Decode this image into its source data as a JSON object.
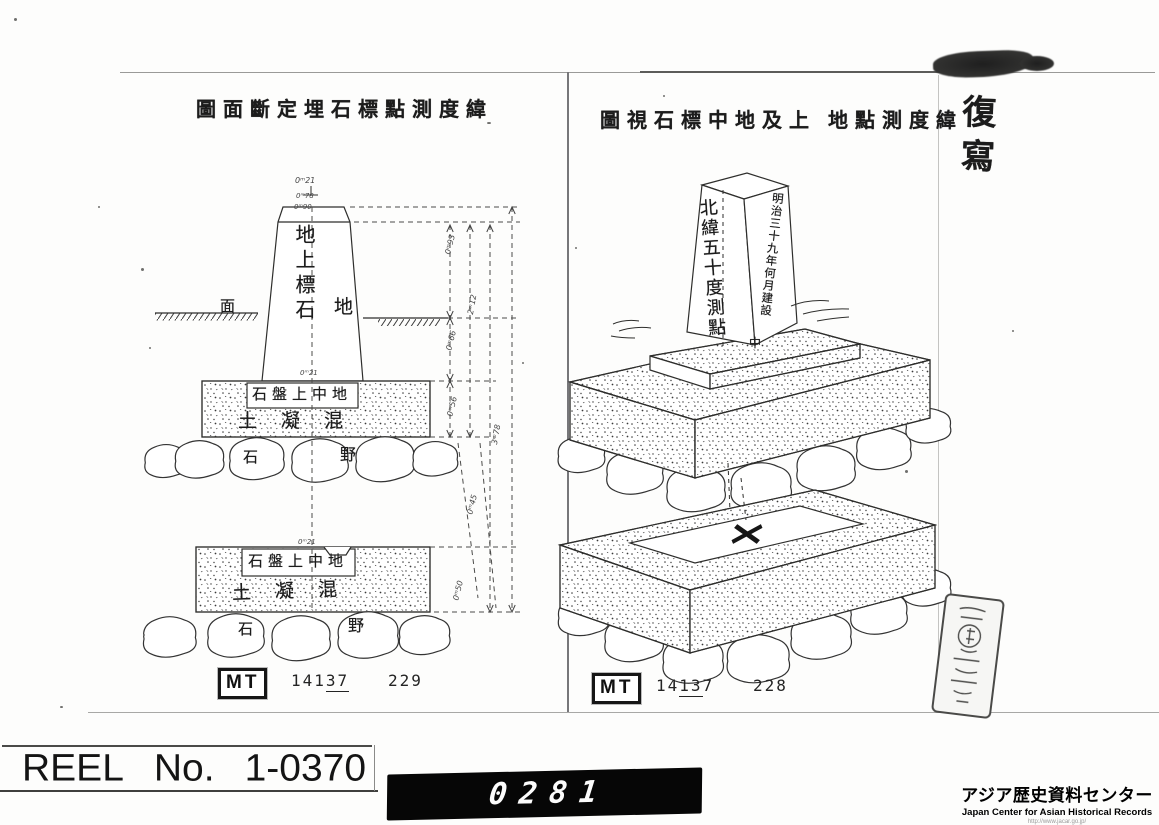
{
  "scan": {
    "copy_stamp_vertical": "復寫",
    "left_page": {
      "title": "圖面斷定埋石標點測度緯",
      "labels": {
        "pillar_vertical": "地上標石",
        "ground_left": "面",
        "ground_right": "地",
        "upper_slab_box": "石盤上中地",
        "upper_concrete": "土凝混",
        "upper_boulder_left": "石",
        "upper_boulder_right": "野",
        "lower_slab_box": "石盤上中地",
        "lower_concrete": "土凝混",
        "lower_boulder_left": "石",
        "lower_boulder_right": "野"
      },
      "dim_labels": [
        "0ᵐ21",
        "0ᵐ78",
        "0ᵐ90",
        "0ᵐ93",
        "0ᵐ66",
        "0ᵐ56",
        "2ᵐ12",
        "3ᵐ78",
        "0ᵐ45",
        "0ᵐ50",
        "0ᵐ21",
        "0ᵐ21"
      ],
      "footer": {
        "mt_label": "MT",
        "number_prefix": "141",
        "number_underlined": "37",
        "number_suffix": "",
        "page_number": "229"
      }
    },
    "right_page": {
      "title": "圖視石標中地及上 地點測度緯",
      "labels": {
        "obelisk_front_vertical": "北緯五十度測點",
        "obelisk_side_vertical": "明治三十九年何月建設",
        "obelisk_base_char": "中"
      },
      "footer": {
        "mt_label": "MT",
        "number_prefix": "14",
        "number_underlined": "13",
        "number_suffix": "7",
        "page_number": "228"
      }
    }
  },
  "footer_bar": {
    "reel_word": "REEL",
    "reel_no": "No.",
    "reel_value": "1-0370",
    "counter_value": "0281",
    "logo_jp": "アジア歴史資料センター",
    "logo_en": "Japan Center for Asian Historical Records",
    "logo_url": "http://www.jacar.go.jp/"
  }
}
